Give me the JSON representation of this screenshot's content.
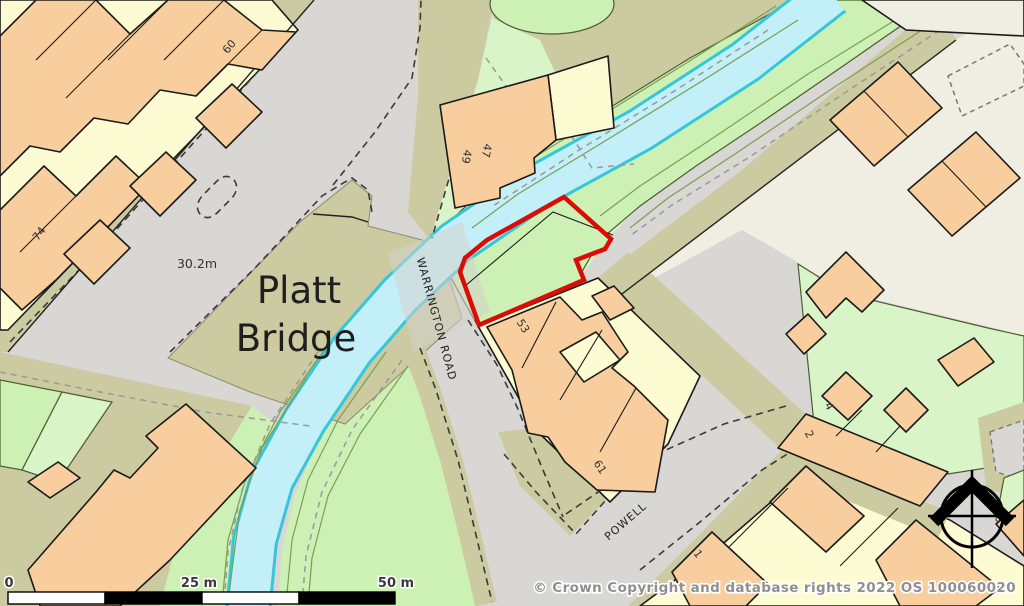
{
  "map": {
    "place_label": {
      "line1": "Platt",
      "line2": "Bridge"
    },
    "spot_height": "30.2m",
    "roads": {
      "warrington": "WARRINGTON ROAD",
      "powell": "POWELL"
    },
    "house_numbers": {
      "n60": "60",
      "n74": "74",
      "n47": "47",
      "n49": "49",
      "n53": "53",
      "n61": "61",
      "n4": "4",
      "n2": "2",
      "n1": "1"
    },
    "scale_bar": {
      "zero": "0",
      "mid": "25 m",
      "end": "50 m"
    },
    "copyright": "© Crown Copyright and database rights 2022 OS 100060020",
    "plot": {
      "outline_color": "#db0b05"
    },
    "colors": {
      "road": "#d9d7d4",
      "verge": "#cbcaa0",
      "building_orange": "#f8ce9e",
      "building_yellow": "#fdfbd2",
      "vegetation": "#cdf0b4",
      "vegetation_light": "#d9f4c6",
      "water_fill": "#c3eff8",
      "water_edge": "#35c6da",
      "yard_beige": "#f0ede2",
      "plot_red": "#db0b05"
    }
  }
}
